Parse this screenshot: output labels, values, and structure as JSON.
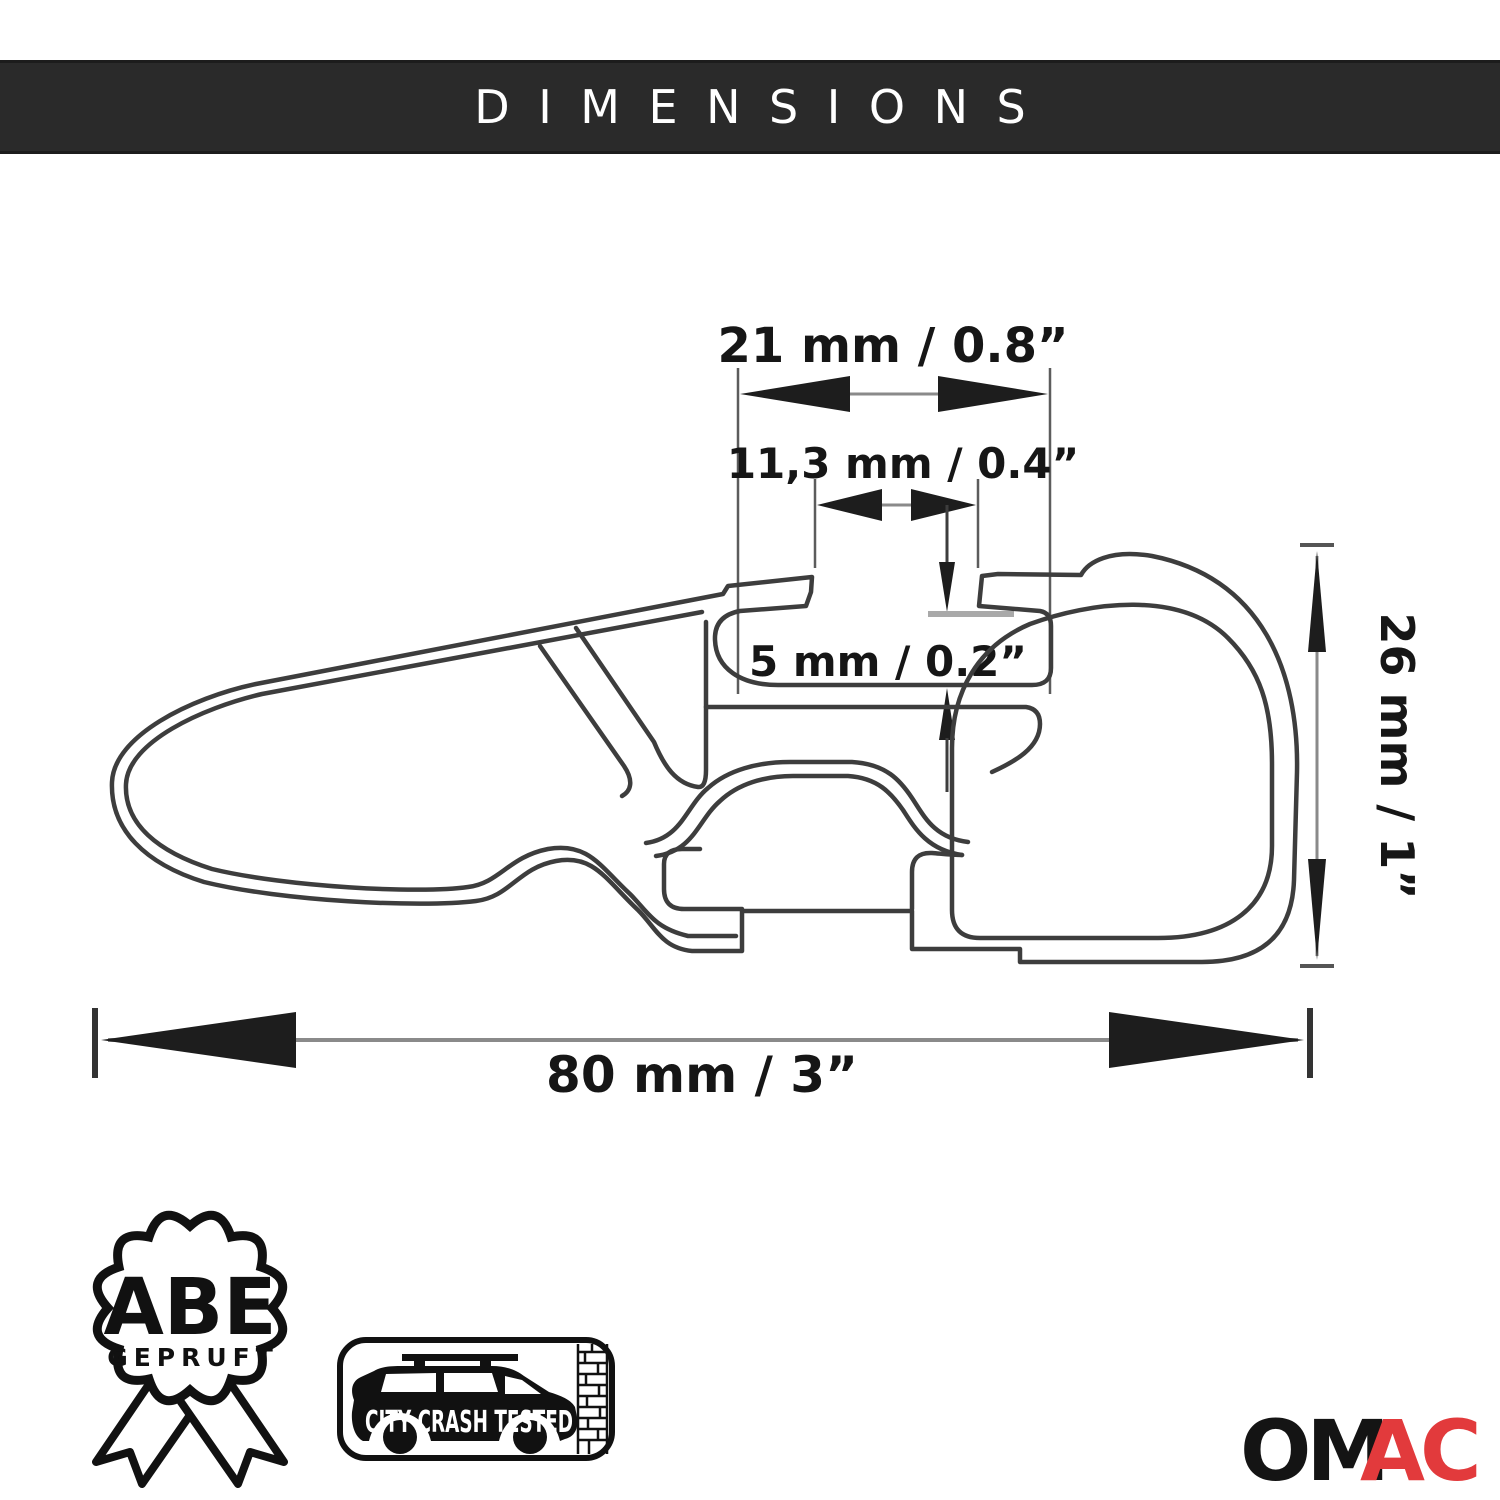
{
  "header": {
    "title": "DIMENSIONS",
    "bg": "#2a2a2a",
    "text_color": "#ffffff"
  },
  "diagram": {
    "type": "roof-rack crossbar cross-section technical drawing",
    "line_color": "#3d3d3d",
    "dimensions": {
      "top_width": "21 mm / 0.8”",
      "slot_width": "11,3 mm / 0.4”",
      "slot_depth": "5 mm / 0.2”",
      "height": "26 mm / 1”",
      "total_width": "80 mm / 3”"
    }
  },
  "badges": {
    "abe": {
      "line1": "ABE",
      "line2": "GEPRUFT"
    },
    "crash": {
      "label": "CITY CRASH TESTED"
    }
  },
  "logo": {
    "part1": "OM",
    "part2": "AC",
    "black": "#141414",
    "accent": "#e23a3c"
  }
}
